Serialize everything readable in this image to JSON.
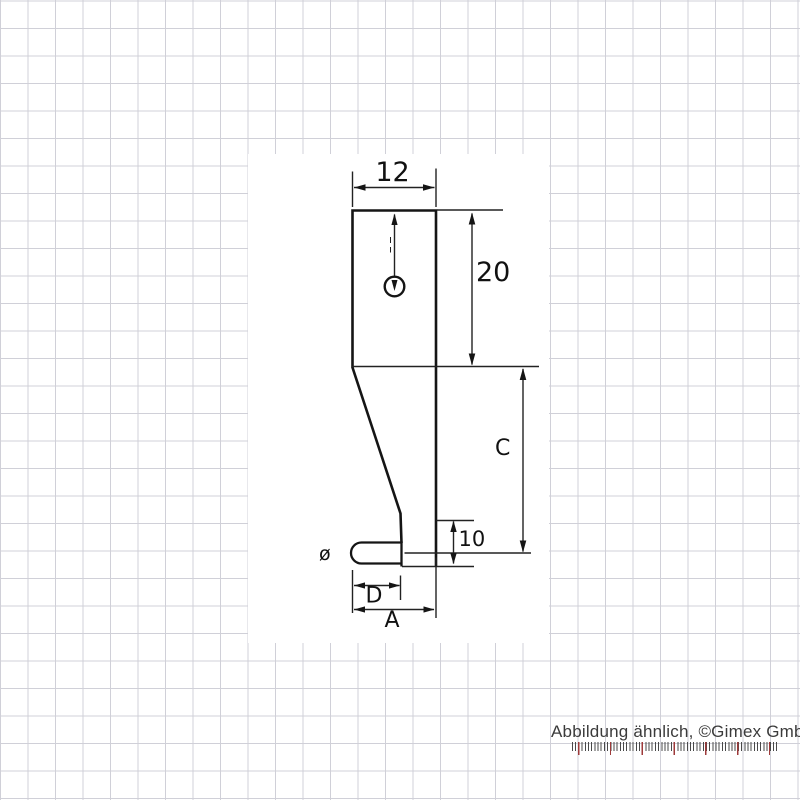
{
  "product_drawing": {
    "description": "technical dimension drawing of a measuring probe insert",
    "labels": {
      "width": "12",
      "height_upper": "20",
      "height_total": "C",
      "tip_height": "10",
      "diameter_symbol": "ø",
      "tip_length": "D",
      "foot_length": "A"
    }
  },
  "footer": {
    "caption": "Abbildung ähnlich, ©Gimex GmbH"
  },
  "colors": {
    "outline": "#151515",
    "grid_line": "#d0d0d8",
    "caption_text": "#3b3b3b",
    "ruler_major_tick": "#9e3a3a",
    "ruler_minor_tick": "#4a4a4a"
  }
}
